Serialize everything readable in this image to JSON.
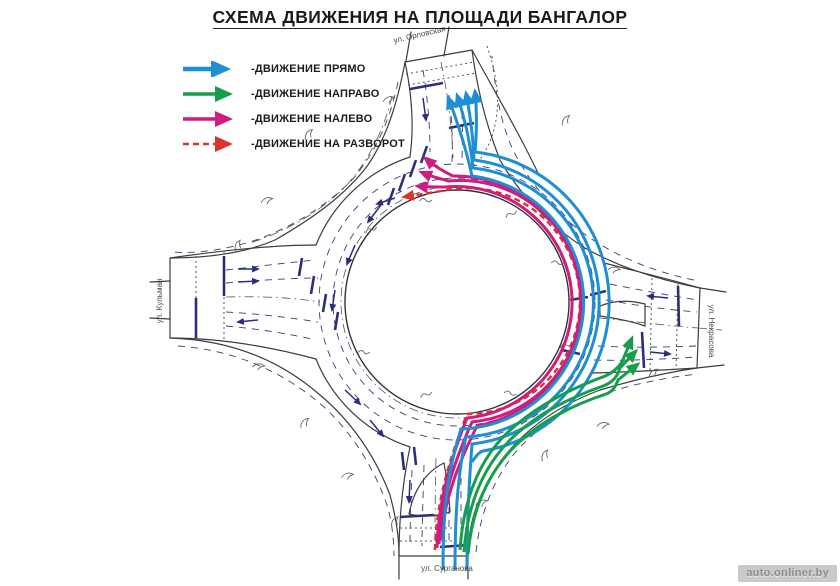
{
  "title": "СХЕМА ДВИЖЕНИЯ НА ПЛОЩАДИ БАНГАЛОР",
  "legend": {
    "items": [
      {
        "label": "-ДВИЖЕНИЕ ПРЯМО",
        "color": "#1e8fd2",
        "style": "solid"
      },
      {
        "label": "-ДВИЖЕНИЕ НАПРАВО",
        "color": "#179e4b",
        "style": "solid"
      },
      {
        "label": "-ДВИЖЕНИЕ НАЛЕВО",
        "color": "#ce1d7d",
        "style": "solid"
      },
      {
        "label": "-ДВИЖЕНИЕ НА РАЗВОРОТ",
        "color": "#d8352c",
        "style": "dashed"
      }
    ]
  },
  "streets": {
    "north": "ул. Орловская",
    "west": "ул. Кульман",
    "east": "ул. Некрасова",
    "south": "ул. Сурганова"
  },
  "watermark": "auto.onliner.by",
  "colors": {
    "straight": "#1e8fd2",
    "right": "#179e4b",
    "left": "#ce1d7d",
    "uturn": "#d8352c",
    "ink": "#3d3d3d",
    "mark": "#2d2d7e",
    "lane": "#3c3c7a"
  }
}
